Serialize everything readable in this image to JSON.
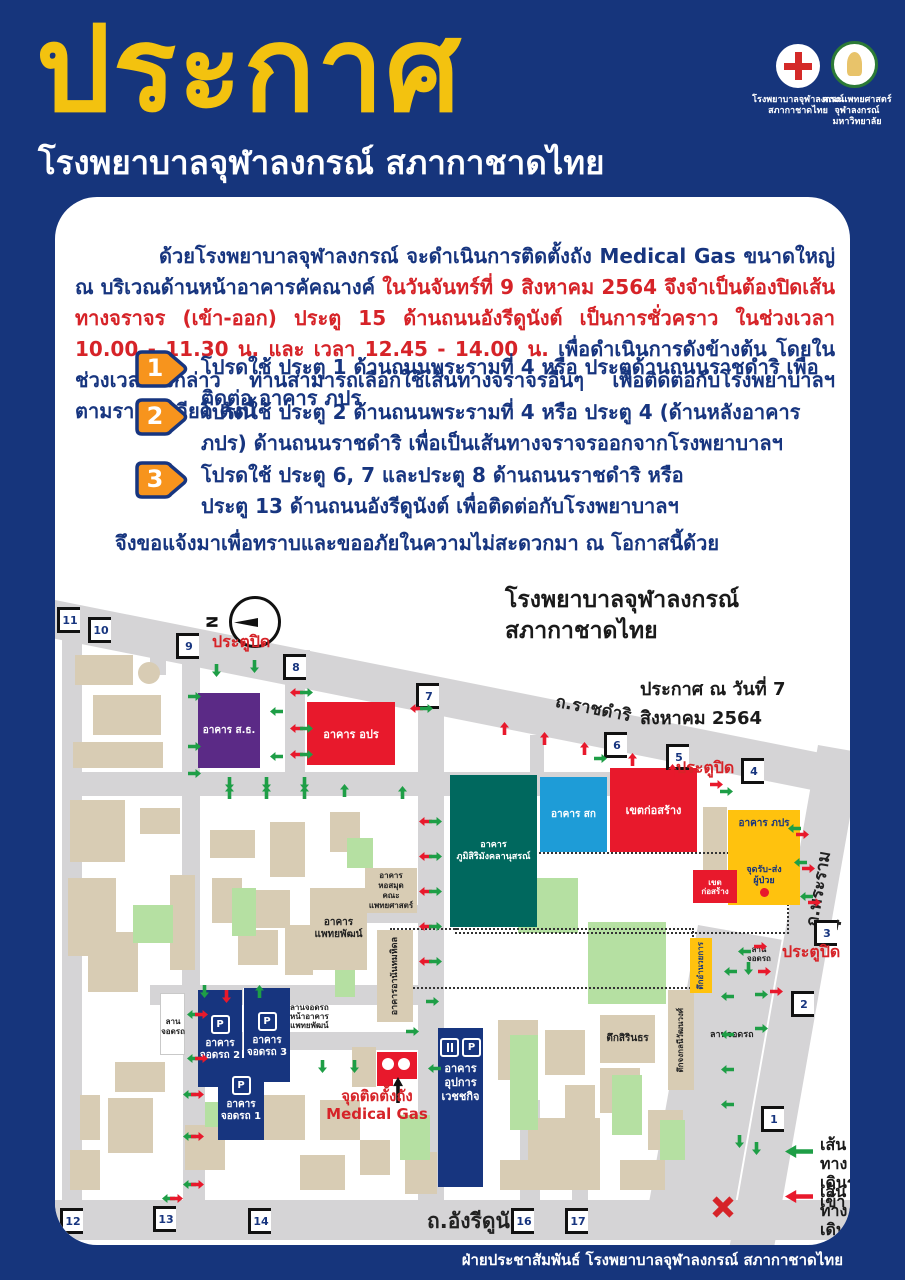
{
  "colors": {
    "background": "#16357c",
    "title_yellow": "#f3c20f",
    "alert_red": "#d62328",
    "body_navy": "#17357f",
    "badge_orange": "#f7941d",
    "map_purple": "#5b2a86",
    "map_red": "#e8192c",
    "map_teal": "#00685e",
    "map_cyan": "#1e9cd7",
    "map_yellow": "#ffc20e",
    "map_navy": "#17357f",
    "road_gray": "#d5d4d6",
    "in_green": "#1e9e46",
    "out_red": "#e8192c"
  },
  "header": {
    "title": "ประกาศ",
    "subtitle": "โรงพยาบาลจุฬาลงกรณ์ สภากาชาดไทย",
    "logo1_caption": "โรงพยาบาลจุฬาลงกรณ์\nสภากาชาดไทย",
    "logo2_caption": "คณะแพทยศาสตร์\nจุฬาลงกรณ์มหาวิทยาลัย"
  },
  "announcement": {
    "p1_normal": "ด้วยโรงพยาบาลจุฬาลงกรณ์ จะดำเนินการติดตั้งถัง Medical Gas ขนาดใหญ่ ณ บริเวณด้านหน้าอาคารคัคณางค์ ",
    "p1_red": "ในวันจันทร์ที่ 9 สิงหาคม 2564 จึงจำเป็นต้องปิดเส้นทางจราจร (เข้า-ออก) ประตู 15 ด้านถนนอังรีดูนังต์ เป็นการชั่วคราว ในช่วงเวลา 10.00 - 11.30 น. และ เวลา 12.45 - 14.00 น.",
    "p1_tail": " เพื่อดำเนินการดังข้างต้น โดยในช่วงเวลาดังกล่าว ท่านสามารถเลือกใช้เส้นทางจราจรอื่นๆ เพื่อติดต่อกับโรงพยาบาลฯ ตามรายละเอียด ดังนี้",
    "items": [
      {
        "num": "1",
        "text": "โปรดใช้ ประตู 1 ด้านถนนพระรามที่ 4 หรือ ประตูด้านถนนราชดำริ เพื่อติดต่อ อาคาร ภปร"
      },
      {
        "num": "2",
        "text": "โปรดใช้ ประตู 2 ด้านถนนพระรามที่ 4 หรือ ประตู 4 (ด้านหลังอาคาร ภปร) ด้านถนนราชดำริ เพื่อเป็นเส้นทางจราจรออกจากโรงพยาบาลฯ"
      },
      {
        "num": "3",
        "text": "โปรดใช้ ประตู 6, 7 และประตู 8 ด้านถนนราชดำริ หรือ\nประตู 13 ด้านถนนอังรีดูนังต์ เพื่อติดต่อกับโรงพยาบาลฯ"
      }
    ],
    "closing": "จึงขอแจ้งมาเพื่อทราบและขออภัยในความไม่สะดวกมา ณ โอกาสนี้ด้วย"
  },
  "map": {
    "title": "โรงพยาบาลจุฬาลงกรณ์\nสภากาชาดไทย",
    "date": "ประกาศ ณ วันที่ 7 สิงหาคม 2564",
    "compass_n": "N",
    "roads": {
      "top": "ถ.ราชดำริ",
      "right": "ถ.พระราม 4",
      "bottom": "ถ.อังรีดูนังต์"
    },
    "gate_closed": "ประตูปิด",
    "medical_gas_label": "จุดติดตั้งถัง\nMedical Gas",
    "legend": [
      {
        "label": "เส้นทาง\nเดินรถเข้า"
      },
      {
        "label": "เส้นทาง\nเดินรถออก"
      }
    ],
    "buildings": [
      {
        "label": "อาคาร ส.ธ."
      },
      {
        "label": "อาคาร อปร"
      },
      {
        "label": "อาคาร\nภูมิสิริมังคลานุสรณ์"
      },
      {
        "label": "อาคาร สก"
      },
      {
        "label": "เขตก่อสร้าง"
      },
      {
        "label": "อาคาร ภปร"
      },
      {
        "label": "จุดรับ-ส่ง\nผู้ป่วย"
      },
      {
        "label": "เขต\nก่อสร้าง"
      },
      {
        "label": "อาคาร\nหอสมุด\nคณะแพทยศาสตร์"
      },
      {
        "label": "อาคาร\nแพทยพัฒน์"
      },
      {
        "label": "อาคารอานันทมหิดล"
      },
      {
        "label": "อาคาร\nจอดรถ 2"
      },
      {
        "label": "อาคาร\nจอดรถ 3"
      },
      {
        "label": "อาคาร\nจอดรถ 1"
      },
      {
        "label": "อาคาร\nอุปการ\nเวชชกิจ"
      },
      {
        "label": "ตึกสิรินธร"
      },
      {
        "label": "ตึกจงกลนีวัฒนวงศ์"
      },
      {
        "label": "ตึกอำนวยการ"
      },
      {
        "label": "ลานจอดรถ"
      },
      {
        "label": "ลาน\nจอดรถ"
      },
      {
        "label": "ลาน\nจอดรถ"
      },
      {
        "label": "ลานจอดรถ\nหน้าอาคาร\nแพทยพัฒน์"
      }
    ],
    "p_icon": "P",
    "gates": [
      {
        "n": "11",
        "x": 2,
        "y": 410
      },
      {
        "n": "10",
        "x": 33,
        "y": 420
      },
      {
        "n": "9",
        "x": 121,
        "y": 436
      },
      {
        "n": "8",
        "x": 228,
        "y": 457
      },
      {
        "n": "7",
        "x": 361,
        "y": 486
      },
      {
        "n": "6",
        "x": 549,
        "y": 535
      },
      {
        "n": "5",
        "x": 611,
        "y": 547
      },
      {
        "n": "4",
        "x": 686,
        "y": 561
      },
      {
        "n": "3",
        "x": 759,
        "y": 723
      },
      {
        "n": "2",
        "x": 736,
        "y": 794
      },
      {
        "n": "1",
        "x": 706,
        "y": 909
      },
      {
        "n": "12",
        "x": 5,
        "y": 1011
      },
      {
        "n": "13",
        "x": 98,
        "y": 1009
      },
      {
        "n": "14",
        "x": 193,
        "y": 1011
      },
      {
        "n": "16",
        "x": 456,
        "y": 1011
      },
      {
        "n": "17",
        "x": 510,
        "y": 1011
      }
    ],
    "closed_labels": [
      {
        "x": 157,
        "y": 433
      },
      {
        "x": 621,
        "y": 559
      },
      {
        "x": 727,
        "y": 743
      }
    ],
    "blocks": [
      {
        "x": 20,
        "y": 458,
        "w": 58,
        "h": 30,
        "c": "tan"
      },
      {
        "x": 38,
        "y": 498,
        "w": 68,
        "h": 40,
        "c": "tan"
      },
      {
        "x": 18,
        "y": 545,
        "w": 90,
        "h": 26,
        "c": "tan"
      },
      {
        "x": 45,
        "y": 465,
        "w": 22,
        "h": 22,
        "c": "tan",
        "r": 1
      },
      {
        "x": 83,
        "y": 465,
        "w": 22,
        "h": 22,
        "c": "tan",
        "r": 1
      },
      {
        "x": 15,
        "y": 603,
        "w": 55,
        "h": 62,
        "c": "tan"
      },
      {
        "x": 85,
        "y": 611,
        "w": 40,
        "h": 26,
        "c": "tan"
      },
      {
        "x": 13,
        "y": 681,
        "w": 48,
        "h": 78,
        "c": "tan"
      },
      {
        "x": 33,
        "y": 735,
        "w": 50,
        "h": 60,
        "c": "tan"
      },
      {
        "x": 115,
        "y": 678,
        "w": 25,
        "h": 95,
        "c": "tan"
      },
      {
        "x": 155,
        "y": 633,
        "w": 45,
        "h": 28,
        "c": "tan"
      },
      {
        "x": 215,
        "y": 625,
        "w": 35,
        "h": 55,
        "c": "tan"
      },
      {
        "x": 275,
        "y": 615,
        "w": 30,
        "h": 40,
        "c": "tan"
      },
      {
        "x": 157,
        "y": 681,
        "w": 30,
        "h": 45,
        "c": "tan"
      },
      {
        "x": 200,
        "y": 693,
        "w": 35,
        "h": 38,
        "c": "tan"
      },
      {
        "x": 183,
        "y": 733,
        "w": 40,
        "h": 35,
        "c": "tan"
      },
      {
        "x": 230,
        "y": 728,
        "w": 28,
        "h": 50,
        "c": "tan"
      },
      {
        "x": 258,
        "y": 505,
        "w": 35,
        "h": 60,
        "c": "tan"
      },
      {
        "x": 300,
        "y": 515,
        "w": 28,
        "h": 45,
        "c": "tan"
      },
      {
        "x": 60,
        "y": 865,
        "w": 50,
        "h": 30,
        "c": "tan"
      },
      {
        "x": 25,
        "y": 898,
        "w": 20,
        "h": 45,
        "c": "tan"
      },
      {
        "x": 53,
        "y": 901,
        "w": 45,
        "h": 55,
        "c": "tan"
      },
      {
        "x": 130,
        "y": 928,
        "w": 40,
        "h": 45,
        "c": "tan"
      },
      {
        "x": 15,
        "y": 953,
        "w": 30,
        "h": 40,
        "c": "tan"
      },
      {
        "x": 200,
        "y": 898,
        "w": 50,
        "h": 45,
        "c": "tan"
      },
      {
        "x": 265,
        "y": 903,
        "w": 40,
        "h": 40,
        "c": "tan"
      },
      {
        "x": 245,
        "y": 958,
        "w": 45,
        "h": 35,
        "c": "tan"
      },
      {
        "x": 305,
        "y": 943,
        "w": 30,
        "h": 35,
        "c": "tan"
      },
      {
        "x": 297,
        "y": 850,
        "w": 24,
        "h": 40,
        "c": "tan"
      },
      {
        "x": 473,
        "y": 921,
        "w": 72,
        "h": 72,
        "c": "tan"
      },
      {
        "x": 443,
        "y": 823,
        "w": 40,
        "h": 60,
        "c": "tan"
      },
      {
        "x": 490,
        "y": 833,
        "w": 40,
        "h": 45,
        "c": "tan"
      },
      {
        "x": 545,
        "y": 871,
        "w": 40,
        "h": 45,
        "c": "tan"
      },
      {
        "x": 593,
        "y": 913,
        "w": 35,
        "h": 40,
        "c": "tan"
      },
      {
        "x": 510,
        "y": 888,
        "w": 30,
        "h": 35,
        "c": "tan"
      },
      {
        "x": 565,
        "y": 963,
        "w": 45,
        "h": 30,
        "c": "tan"
      },
      {
        "x": 445,
        "y": 963,
        "w": 40,
        "h": 30,
        "c": "tan"
      },
      {
        "x": 648,
        "y": 610,
        "w": 24,
        "h": 66,
        "c": "tan"
      },
      {
        "x": 350,
        "y": 955,
        "w": 32,
        "h": 42,
        "c": "tan"
      },
      {
        "x": 78,
        "y": 708,
        "w": 40,
        "h": 38,
        "c": "green"
      },
      {
        "x": 177,
        "y": 691,
        "w": 24,
        "h": 48,
        "c": "green"
      },
      {
        "x": 292,
        "y": 641,
        "w": 26,
        "h": 30,
        "c": "green"
      },
      {
        "x": 463,
        "y": 681,
        "w": 60,
        "h": 55,
        "c": "green"
      },
      {
        "x": 533,
        "y": 725,
        "w": 78,
        "h": 82,
        "c": "green"
      },
      {
        "x": 455,
        "y": 838,
        "w": 28,
        "h": 95,
        "c": "green"
      },
      {
        "x": 345,
        "y": 918,
        "w": 30,
        "h": 45,
        "c": "green"
      },
      {
        "x": 557,
        "y": 878,
        "w": 30,
        "h": 60,
        "c": "green"
      },
      {
        "x": 605,
        "y": 923,
        "w": 25,
        "h": 40,
        "c": "green"
      },
      {
        "x": 150,
        "y": 905,
        "w": 25,
        "h": 25,
        "c": "green"
      },
      {
        "x": 280,
        "y": 760,
        "w": 20,
        "h": 40,
        "c": "green"
      },
      {
        "x": 105,
        "y": 796,
        "w": 25,
        "h": 62,
        "c": "white"
      }
    ],
    "arrows": [
      {
        "x": 157,
        "y": 467,
        "r": 180,
        "c": "g"
      },
      {
        "x": 195,
        "y": 463,
        "r": 180,
        "c": "g"
      },
      {
        "x": 135,
        "y": 493,
        "r": 90,
        "c": "g"
      },
      {
        "x": 135,
        "y": 543,
        "r": 90,
        "c": "g"
      },
      {
        "x": 135,
        "y": 570,
        "r": 90,
        "c": "g"
      },
      {
        "x": 217,
        "y": 508,
        "r": -90,
        "c": "g"
      },
      {
        "x": 217,
        "y": 553,
        "r": -90,
        "c": "g"
      },
      {
        "x": 237,
        "y": 489,
        "r": -90,
        "c": "r"
      },
      {
        "x": 247,
        "y": 489,
        "r": 90,
        "c": "g"
      },
      {
        "x": 237,
        "y": 525,
        "r": -90,
        "c": "r"
      },
      {
        "x": 247,
        "y": 525,
        "r": 90,
        "c": "g"
      },
      {
        "x": 237,
        "y": 551,
        "r": -90,
        "c": "r"
      },
      {
        "x": 247,
        "y": 551,
        "r": 90,
        "c": "g"
      },
      {
        "x": 170,
        "y": 580,
        "r": 180,
        "c": "g"
      },
      {
        "x": 170,
        "y": 589,
        "r": 0,
        "c": "g"
      },
      {
        "x": 207,
        "y": 580,
        "r": 180,
        "c": "g"
      },
      {
        "x": 207,
        "y": 589,
        "r": 0,
        "c": "g"
      },
      {
        "x": 245,
        "y": 580,
        "r": 180,
        "c": "g"
      },
      {
        "x": 245,
        "y": 589,
        "r": 0,
        "c": "g"
      },
      {
        "x": 285,
        "y": 587,
        "r": 0,
        "c": "g"
      },
      {
        "x": 343,
        "y": 589,
        "r": 0,
        "c": "g"
      },
      {
        "x": 357,
        "y": 505,
        "r": -90,
        "c": "r"
      },
      {
        "x": 367,
        "y": 505,
        "r": 90,
        "c": "g"
      },
      {
        "x": 445,
        "y": 525,
        "r": 0,
        "c": "r"
      },
      {
        "x": 485,
        "y": 535,
        "r": 0,
        "c": "r"
      },
      {
        "x": 525,
        "y": 545,
        "r": 0,
        "c": "r"
      },
      {
        "x": 573,
        "y": 556,
        "r": 0,
        "c": "r"
      },
      {
        "x": 613,
        "y": 567,
        "r": 0,
        "c": "r"
      },
      {
        "x": 541,
        "y": 555,
        "r": 90,
        "c": "g"
      },
      {
        "x": 657,
        "y": 581,
        "r": 90,
        "c": "r"
      },
      {
        "x": 667,
        "y": 588,
        "r": 90,
        "c": "g"
      },
      {
        "x": 735,
        "y": 625,
        "r": -90,
        "c": "g"
      },
      {
        "x": 743,
        "y": 631,
        "r": 90,
        "c": "r"
      },
      {
        "x": 741,
        "y": 659,
        "r": -90,
        "c": "g"
      },
      {
        "x": 749,
        "y": 665,
        "r": 90,
        "c": "r"
      },
      {
        "x": 747,
        "y": 693,
        "r": -90,
        "c": "g"
      },
      {
        "x": 755,
        "y": 699,
        "r": 90,
        "c": "r"
      },
      {
        "x": 685,
        "y": 748,
        "r": -90,
        "c": "g"
      },
      {
        "x": 701,
        "y": 743,
        "r": 90,
        "c": "r"
      },
      {
        "x": 671,
        "y": 768,
        "r": -90,
        "c": "g"
      },
      {
        "x": 689,
        "y": 765,
        "r": 180,
        "c": "g"
      },
      {
        "x": 705,
        "y": 768,
        "r": 90,
        "c": "r"
      },
      {
        "x": 366,
        "y": 618,
        "r": -90,
        "c": "r"
      },
      {
        "x": 376,
        "y": 618,
        "r": 90,
        "c": "g"
      },
      {
        "x": 366,
        "y": 653,
        "r": -90,
        "c": "r"
      },
      {
        "x": 376,
        "y": 653,
        "r": 90,
        "c": "g"
      },
      {
        "x": 366,
        "y": 688,
        "r": -90,
        "c": "r"
      },
      {
        "x": 376,
        "y": 688,
        "r": 90,
        "c": "g"
      },
      {
        "x": 366,
        "y": 723,
        "r": -90,
        "c": "r"
      },
      {
        "x": 376,
        "y": 723,
        "r": 90,
        "c": "g"
      },
      {
        "x": 366,
        "y": 758,
        "r": -90,
        "c": "r"
      },
      {
        "x": 376,
        "y": 758,
        "r": 90,
        "c": "g"
      },
      {
        "x": 373,
        "y": 798,
        "r": 90,
        "c": "g"
      },
      {
        "x": 200,
        "y": 788,
        "r": 0,
        "c": "g"
      },
      {
        "x": 167,
        "y": 793,
        "r": 180,
        "c": "r"
      },
      {
        "x": 145,
        "y": 788,
        "r": 180,
        "c": "g"
      },
      {
        "x": 134,
        "y": 811,
        "r": -90,
        "c": "g"
      },
      {
        "x": 142,
        "y": 811,
        "r": 90,
        "c": "r"
      },
      {
        "x": 134,
        "y": 855,
        "r": -90,
        "c": "g"
      },
      {
        "x": 142,
        "y": 855,
        "r": 90,
        "c": "r"
      },
      {
        "x": 130,
        "y": 891,
        "r": -90,
        "c": "g"
      },
      {
        "x": 138,
        "y": 891,
        "r": 90,
        "c": "r"
      },
      {
        "x": 130,
        "y": 933,
        "r": -90,
        "c": "g"
      },
      {
        "x": 138,
        "y": 933,
        "r": 90,
        "c": "r"
      },
      {
        "x": 130,
        "y": 981,
        "r": -90,
        "c": "g"
      },
      {
        "x": 138,
        "y": 981,
        "r": 90,
        "c": "r"
      },
      {
        "x": 263,
        "y": 863,
        "r": 180,
        "c": "g"
      },
      {
        "x": 295,
        "y": 863,
        "r": 180,
        "c": "g"
      },
      {
        "x": 353,
        "y": 828,
        "r": 90,
        "c": "g"
      },
      {
        "x": 375,
        "y": 865,
        "r": -90,
        "c": "g"
      },
      {
        "x": 668,
        "y": 793,
        "r": -90,
        "c": "g"
      },
      {
        "x": 668,
        "y": 831,
        "r": -90,
        "c": "g"
      },
      {
        "x": 668,
        "y": 866,
        "r": -90,
        "c": "g"
      },
      {
        "x": 702,
        "y": 791,
        "r": 90,
        "c": "g"
      },
      {
        "x": 702,
        "y": 825,
        "r": 90,
        "c": "g"
      },
      {
        "x": 717,
        "y": 788,
        "r": 90,
        "c": "r"
      },
      {
        "x": 668,
        "y": 901,
        "r": -90,
        "c": "g"
      },
      {
        "x": 680,
        "y": 938,
        "r": 180,
        "c": "g"
      },
      {
        "x": 697,
        "y": 945,
        "r": 180,
        "c": "g"
      },
      {
        "x": 109,
        "y": 995,
        "r": -90,
        "c": "g"
      },
      {
        "x": 117,
        "y": 995,
        "r": 90,
        "c": "r"
      }
    ]
  },
  "footer": "ฝ่ายประชาสัมพันธ์ โรงพยาบาลจุฬาลงกรณ์ สภากาชาดไทย"
}
